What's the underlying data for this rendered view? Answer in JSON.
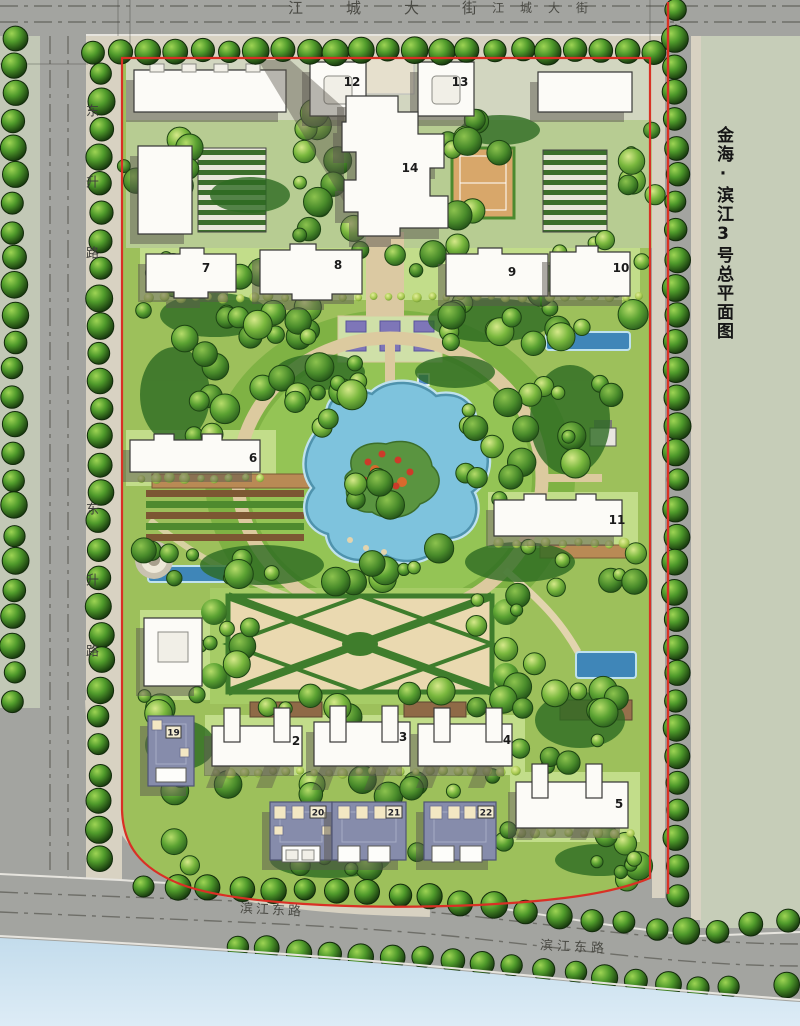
{
  "title": {
    "text": "金海·滨江3号总平面图"
  },
  "roads": {
    "top_left_label": "江城大街",
    "top_right_label": "江城大街",
    "west_upper_label": "东升路",
    "west_lower_label": "东升路",
    "south_left_label": "滨江东路",
    "south_right_label": "滨江东路"
  },
  "buildings": [
    {
      "num": "12"
    },
    {
      "num": "13"
    },
    {
      "num": "14"
    },
    {
      "num": "7"
    },
    {
      "num": "8"
    },
    {
      "num": "9"
    },
    {
      "num": "10"
    },
    {
      "num": "6"
    },
    {
      "num": "11"
    },
    {
      "num": "2"
    },
    {
      "num": "3"
    },
    {
      "num": "4"
    },
    {
      "num": "5"
    },
    {
      "num": "19"
    },
    {
      "num": "20"
    },
    {
      "num": "21"
    },
    {
      "num": "22"
    }
  ],
  "palette": {
    "road": "#a3a4a0",
    "sidewalk": "#d8d2c2",
    "parcel": "#c6cdb8",
    "water": "#cfe3f0",
    "lawn": "#9dc05b",
    "lawn_light": "#c2dd8a",
    "canopy": "#2d6a22",
    "pond": "#7ec3dd",
    "boundary_red": "#d93025",
    "building": "#fcfbf7",
    "villa_roof": "#868cab",
    "path": "#dcca9f"
  }
}
